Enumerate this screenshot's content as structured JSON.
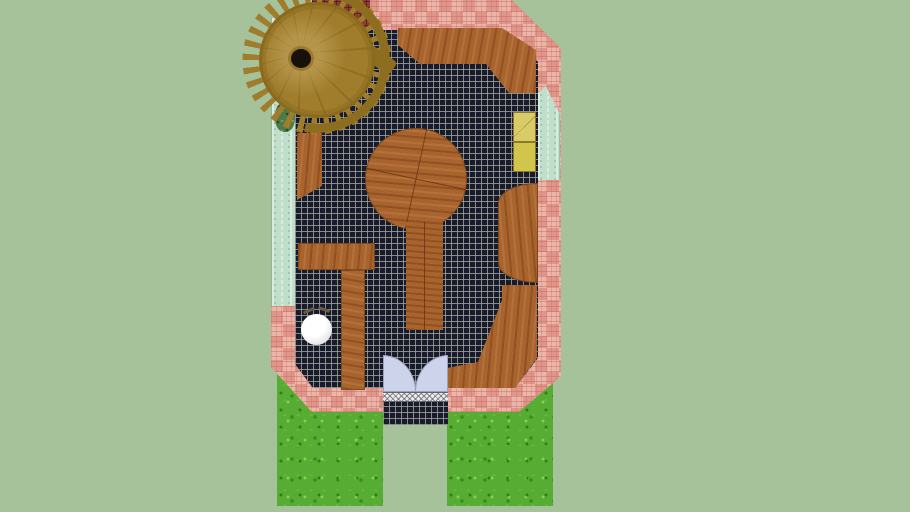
{
  "scene": {
    "type": "3d-model-top-view",
    "description": "Overhead orthographic view of a courtyard/room floor-plan 3D model: dark tiled floor with wooden furniture, pink brick border, mint walls, spiral staircase, double-door entrance and lawn strips",
    "text_visible": false
  },
  "palette": {
    "bg": "#a6c29b",
    "grass": "#57ac33",
    "brick": "#e59e92",
    "brick_line": "#c4766a",
    "mint": "#c0dfca",
    "tile": "#191a2e",
    "tile_line": "#a2ac98",
    "wood": "#a9642e",
    "wood_dark": "#5f3310",
    "stair_wood": "#a07d2c",
    "door": "#ccd3ea",
    "threshold": "#ededed",
    "yellow_top": "#d9cc67",
    "yellow_bottom": "#d2c54c",
    "sphere": "#ffffff",
    "mat": "#8e3c34",
    "plant": "#4e7a46",
    "hub": "#17100b"
  },
  "objects": [
    {
      "name": "spiral-staircase",
      "color": "#a07d2c"
    },
    {
      "name": "brick-patio-border",
      "color": "#e59e92"
    },
    {
      "name": "tiled-floor",
      "color": "#191a2e"
    },
    {
      "name": "mint-wall-left",
      "color": "#c0dfca"
    },
    {
      "name": "mint-wall-right",
      "color": "#c0dfca"
    },
    {
      "name": "wood-bench-top",
      "color": "#a9642e"
    },
    {
      "name": "round-wood-table-with-runner",
      "color": "#a9642e"
    },
    {
      "name": "wood-half-round-table",
      "color": "#a9642e"
    },
    {
      "name": "wood-l-bench",
      "color": "#a9642e"
    },
    {
      "name": "wood-corner-bench",
      "color": "#a9642e"
    },
    {
      "name": "yellow-storage-boxes",
      "color": "#d9cc67"
    },
    {
      "name": "white-sphere-stool",
      "color": "#ffffff"
    },
    {
      "name": "double-door-swing",
      "color": "#ccd3ea"
    },
    {
      "name": "entrance-threshold",
      "color": "#ededed"
    },
    {
      "name": "lawn-left",
      "color": "#57ac33"
    },
    {
      "name": "lawn-right",
      "color": "#57ac33"
    },
    {
      "name": "red-door-mat",
      "color": "#8e3c34"
    },
    {
      "name": "wall-plant",
      "color": "#4e7a46"
    }
  ]
}
